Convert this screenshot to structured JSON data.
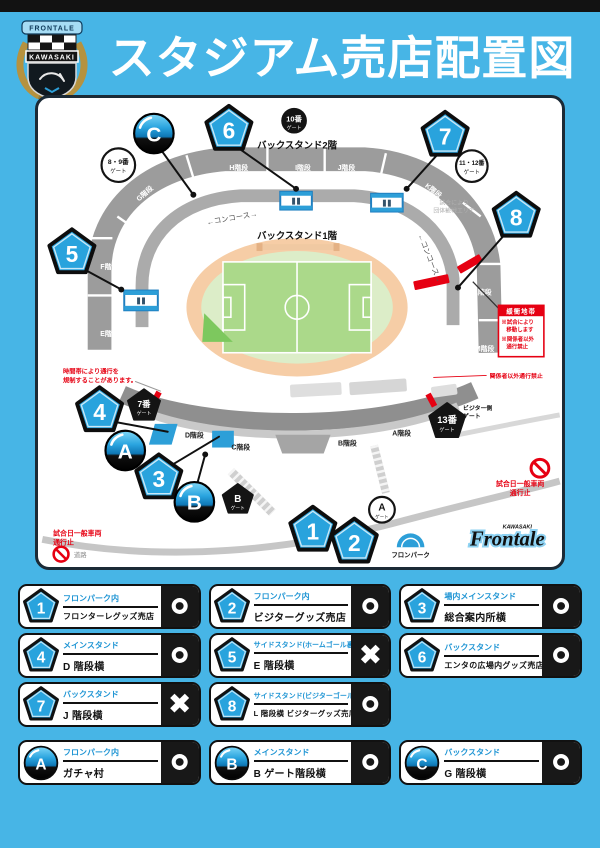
{
  "header": {
    "title": "スタジアム売店配置図",
    "crest": {
      "top": "FRONTALE",
      "band": "KAWASAKI"
    }
  },
  "colors": {
    "background": "#47b5e6",
    "accent_blue": "#29a3dd",
    "alert_red": "#e60012"
  },
  "map": {
    "back2f": "バックスタンド2階",
    "back1f": "バックスタンド1階",
    "concourse": "←コンコース→",
    "stairs": {
      "g": "G階段",
      "h": "H階段",
      "i": "I階段",
      "j": "J階段",
      "k": "K階段",
      "f": "F階段",
      "e": "E階段",
      "l": "L階段",
      "m": "M階段",
      "d": "D階段",
      "c": "C階段",
      "b": "B階段",
      "a": "A階段"
    },
    "gates": {
      "g10": {
        "n": "10番",
        "s": "ゲート"
      },
      "g89": {
        "n": "8・9番",
        "s": "ゲート"
      },
      "g1112": {
        "n": "11・12番",
        "s": "ゲート"
      },
      "g7": {
        "n": "7番",
        "s": "ゲート"
      },
      "g13": {
        "n": "13番",
        "s": "ゲート"
      },
      "gb": {
        "n": "B",
        "s": "ゲート"
      },
      "ga": {
        "n": "A",
        "s": "ゲート"
      }
    },
    "markers": {
      "n1": "1",
      "n2": "2",
      "n3": "3",
      "n4": "4",
      "n5": "5",
      "n6": "6",
      "n7": "7",
      "n8": "8",
      "a": "A",
      "b": "B",
      "c": "C"
    },
    "notes": {
      "restrict": {
        "l1": "時間帯により通行を",
        "l2": "規制することがあります。"
      },
      "staff_only": "関係者以外通行禁止",
      "group": {
        "l1": "試合により",
        "l2": "団体観戦エリア"
      },
      "visitor": {
        "l1": "ビジター側",
        "l2": "ゲート"
      },
      "no_cars_right": {
        "l1": "試合日一般車両",
        "l2": "通行止"
      },
      "no_cars_left": {
        "l1": "試合日一般車両",
        "l2": "通行止"
      },
      "road": "道路"
    },
    "buffer": {
      "title": "緩衝地帯",
      "l1": "※試合により",
      "l2": "移動します",
      "l3": "※関係者以外",
      "l4": "通行禁止"
    },
    "fronpark": "フロンパーク",
    "frontale": {
      "top": "KAWASAKI",
      "name": "Frontale"
    }
  },
  "legend": {
    "items": [
      {
        "id": "1",
        "type": "pentagon",
        "location": "フロンパーク内",
        "name": "フロンターレグッズ売店",
        "mark": "○"
      },
      {
        "id": "2",
        "type": "pentagon",
        "location": "フロンパーク内",
        "name": "ビジターグッズ売店",
        "mark": "○"
      },
      {
        "id": "3",
        "type": "pentagon",
        "location": "場内メインスタンド",
        "name": "総合案内所横",
        "mark": "○"
      },
      {
        "id": "4",
        "type": "pentagon",
        "location": "メインスタンド",
        "name": "D 階段横",
        "mark": "○"
      },
      {
        "id": "5",
        "type": "pentagon",
        "location": "サイドスタンド(ホームゴール裏)",
        "name": "E 階段横",
        "mark": "×"
      },
      {
        "id": "6",
        "type": "pentagon",
        "location": "バックスタンド",
        "name": "エンタの広場内グッズ売店",
        "mark": "○"
      },
      {
        "id": "7",
        "type": "pentagon",
        "location": "バックスタンド",
        "name": "J 階段横",
        "mark": "×"
      },
      {
        "id": "8",
        "type": "pentagon",
        "location": "サイドスタンド(ビジターゴール裏)",
        "name": "L 階段横 ビジターグッズ売店",
        "mark": "○"
      },
      {
        "id": "A",
        "type": "ball",
        "location": "フロンパーク内",
        "name": "ガチャ村",
        "mark": "○"
      },
      {
        "id": "B",
        "type": "ball",
        "location": "メインスタンド",
        "name": "B ゲート階段横",
        "mark": "○"
      },
      {
        "id": "C",
        "type": "ball",
        "location": "バックスタンド",
        "name": "G 階段横",
        "mark": "○"
      }
    ]
  }
}
